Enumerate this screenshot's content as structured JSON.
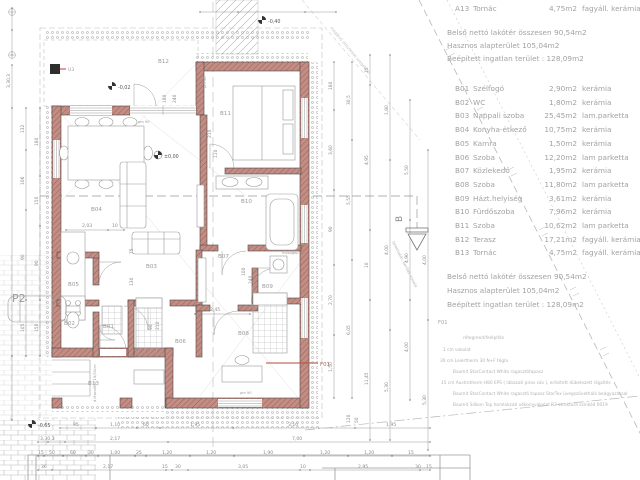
{
  "legend": {
    "partial_top_row": {
      "code": "A13",
      "name": "Tornác",
      "area": "4,75m2",
      "finish": "fagyáll. kerámia"
    },
    "totals": {
      "net": "Belső nettó lakótér összesen  90,54m2",
      "useful": "Hasznos alapterület  105,04m2",
      "built": "Beépített ingatlan terület : 128,09m2"
    },
    "rooms": [
      {
        "code": "B01",
        "name": "Szélfogó",
        "area": "2,90m2",
        "finish": "kerámia"
      },
      {
        "code": "B02",
        "name": "WC",
        "area": "1,80m2",
        "finish": "kerámia"
      },
      {
        "code": "B03",
        "name": "Nappali szoba",
        "area": "25,45m2",
        "finish": "lam.parketta"
      },
      {
        "code": "B04",
        "name": "Konyha-étkező",
        "area": "10,75m2",
        "finish": "kerámia"
      },
      {
        "code": "B05",
        "name": "Kamra",
        "area": "1,50m2",
        "finish": "kerámia"
      },
      {
        "code": "B06",
        "name": "Szoba",
        "area": "12,20m2",
        "finish": "lam parketta"
      },
      {
        "code": "B07",
        "name": "Közlekedő",
        "area": "1,95m2",
        "finish": "kerámia"
      },
      {
        "code": "B08",
        "name": "Szoba",
        "area": "11,80m2",
        "finish": "lam parketta"
      },
      {
        "code": "B09",
        "name": "Házt.helyiség",
        "area": "3,61m2",
        "finish": "kerámia"
      },
      {
        "code": "B10",
        "name": "Fürdőszoba",
        "area": "7,96m2",
        "finish": "kerámia"
      },
      {
        "code": "B11",
        "name": "Szoba",
        "area": "10,62m2",
        "finish": "lam parketta"
      },
      {
        "code": "B12",
        "name": "Terasz",
        "area": "17,21m2",
        "finish": "fagyáll. kerámia"
      },
      {
        "code": "B13",
        "name": "Tornác",
        "area": "4,75m2",
        "finish": "fagyáll. kerámia"
      }
    ],
    "wall_spec": {
      "code": "F01",
      "subtitle": "rétegrend/felépítés",
      "layers": [
        "1 cm  vakolat",
        "30 cm Leiertherm 30 N+F tégla",
        "Baumit StarContact White ragasztótapasz",
        "15 cm Austrotherm H80 EPS ( lábazati piros sáv ), erősített dübelezett rögzítés",
        "Baumit StarContact White ragasztó tapasz  StarTex üvegszövetháló beágyazással",
        "Baumit Silikon Top homlokzati vékonyvakolat R2 struktúra színkód 0019"
      ]
    }
  },
  "plan": {
    "room_labels": {
      "b01": "B01",
      "b02": "B02",
      "b03": "B03",
      "b04": "B04",
      "b05": "B05",
      "b06": "B06",
      "b07": "B07",
      "b08": "B08",
      "b09": "B09",
      "b10": "B10",
      "b11": "B11",
      "b12": "B12",
      "b13": "B13"
    },
    "markers": {
      "section": "B",
      "parking": "P2",
      "column": "U3",
      "wall_type": "F01",
      "washer": "mosógép",
      "steps": "4 lépcsőfok 15/30cm",
      "boundary": "telekhatár, kerítés vonala",
      "path_note": "meglévő útburkolat szegéllyel"
    },
    "levels": {
      "zero": "±0,00",
      "terrace": "-0,02",
      "path": "-0,40",
      "porch": "-0,65"
    },
    "dims": {
      "bottom1": [
        "95",
        "1,10",
        "60",
        "1,95",
        "3,10",
        "1,95"
      ],
      "bottom1v": [
        "120",
        "50"
      ],
      "bottom2": [
        "3,30,3",
        "2,17",
        "7,00"
      ],
      "bottom3": [
        "15",
        "50",
        "60",
        "30",
        "1,00",
        "25",
        "1,20",
        "1,20",
        "1,90",
        "1,20",
        "1,20",
        "15"
      ],
      "bottom4": [
        "36",
        "2,17",
        "15",
        "30",
        "3,05",
        "10",
        "2,95",
        "30",
        "15"
      ],
      "left1": [
        "3,30,3"
      ],
      "left2": [
        "132",
        "106",
        "90",
        "105"
      ],
      "left3": [
        "180",
        "150",
        "90",
        "150"
      ],
      "right1": [
        "180",
        "3,60",
        "90",
        "2,70",
        "1,50"
      ],
      "right2": [
        "30,5",
        "5,55",
        "6,05"
      ],
      "right3": [
        "15",
        "4,95",
        "10",
        "11,45"
      ],
      "right4": [
        "1,80",
        "4,00",
        "5,30"
      ],
      "right5": [
        "5,50",
        "4,90",
        "4,00"
      ],
      "right6": [
        "4,00",
        "5,30"
      ],
      "inner": [
        "180",
        "240",
        "90",
        "210",
        "110",
        "2,03",
        "10",
        "2,45",
        "75",
        "130",
        "100",
        "240",
        "90",
        "210"
      ],
      "pm": "pm 90"
    }
  }
}
